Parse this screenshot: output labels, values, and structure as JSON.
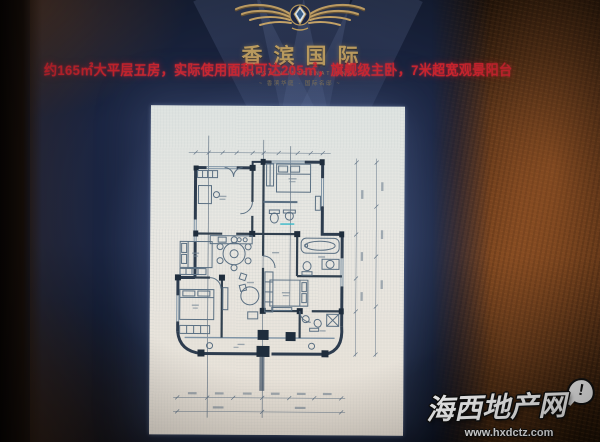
{
  "logo": {
    "brand_name": "香滨国际",
    "brand_sub": "XIANGBIN INTERNATIONAL",
    "tagline": "~ 香滨华庭 · 国际名邸 ~"
  },
  "banner": {
    "text": "约165㎡大平层五房，实际使用面积可达205㎡，旗舰级主卧，7米超宽观景阳台",
    "color": "#c9242e"
  },
  "floorplan": {
    "type": "apartment-blueprint",
    "paper_color": "#e9e8e3",
    "wall_color": "#2d3c4e",
    "furniture_color": "#5b7083",
    "elements": [
      "bedroom-top-left",
      "bedroom-top-right",
      "bathroom-upper",
      "bedroom-mid-left",
      "bedroom-lower-left",
      "master-bedroom",
      "master-bathroom",
      "bathroom-lower",
      "dining-table",
      "living-area",
      "kitchen-counter",
      "balcony",
      "dimension-lines",
      "axis-lines"
    ]
  },
  "watermark": {
    "site_name": "海西地产网",
    "url": "www.hxdctz.com",
    "bubble_mark": "!"
  },
  "colors": {
    "screen_navy": "#1b2542",
    "rust_wall": "#6b3b1a",
    "gold": "#b99a5e"
  }
}
